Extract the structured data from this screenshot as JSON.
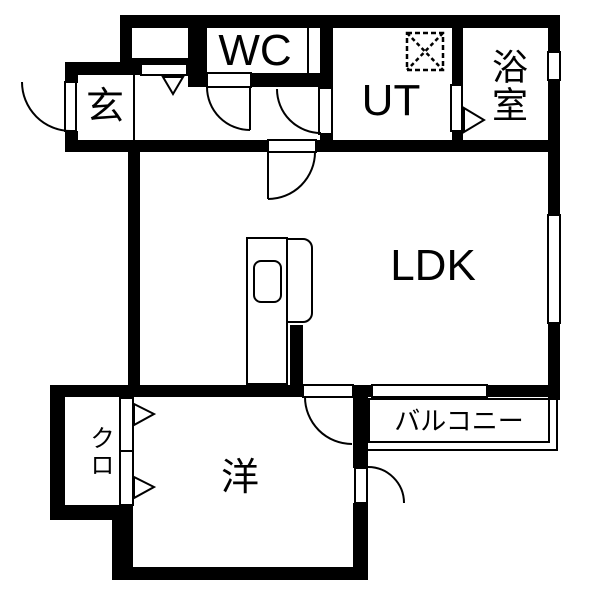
{
  "floorplan": {
    "type": "japanese-apartment-floorplan",
    "rooms": {
      "genkan": {
        "label": "玄"
      },
      "wc": {
        "label": "WC"
      },
      "utility": {
        "label": "UT"
      },
      "bathroom": {
        "label": "浴室"
      },
      "ldk": {
        "label": "LDK"
      },
      "western_room": {
        "label": "洋"
      },
      "closet": {
        "label": "クロ"
      },
      "balcony": {
        "label": "バルコニー"
      }
    },
    "colors": {
      "wall": "#000000",
      "floor": "#ffffff",
      "line": "#000000"
    }
  }
}
